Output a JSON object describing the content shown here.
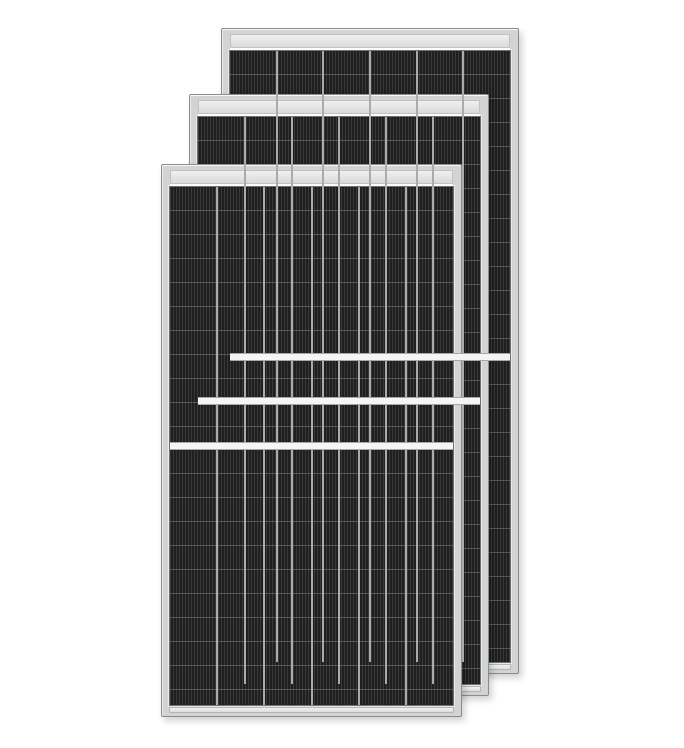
{
  "scene": {
    "description": "Product render of three framed half-cut monocrystalline solar panels stacked with diagonal offsets on a white background",
    "background_color": "#ffffff"
  },
  "panel_style": {
    "frame_color": "#d2d3d4",
    "frame_edge_color": "#8b8c8e",
    "top_band_light_color": "#f0f0f0",
    "top_band_dark_color": "#d9dada",
    "cell_color": "#1f1f1f",
    "finger_line_color": "rgba(255,255,255,0.11)",
    "row_line_color": "rgba(255,255,255,0.22)",
    "column_separator_color": "#c6c7c8",
    "center_divider_color": "#f5f5f6",
    "columns": 6,
    "row_height_px": 24,
    "finger_period_px": 3,
    "top_band_height_px": 12,
    "center_divider_height_px": 6
  },
  "panels": [
    {
      "id": "solar-panel-back",
      "left": 221,
      "top": 28,
      "width": 298,
      "height": 646
    },
    {
      "id": "solar-panel-middle",
      "left": 189,
      "top": 94,
      "width": 300,
      "height": 602
    },
    {
      "id": "solar-panel-front",
      "left": 161,
      "top": 164,
      "width": 301,
      "height": 553
    }
  ]
}
